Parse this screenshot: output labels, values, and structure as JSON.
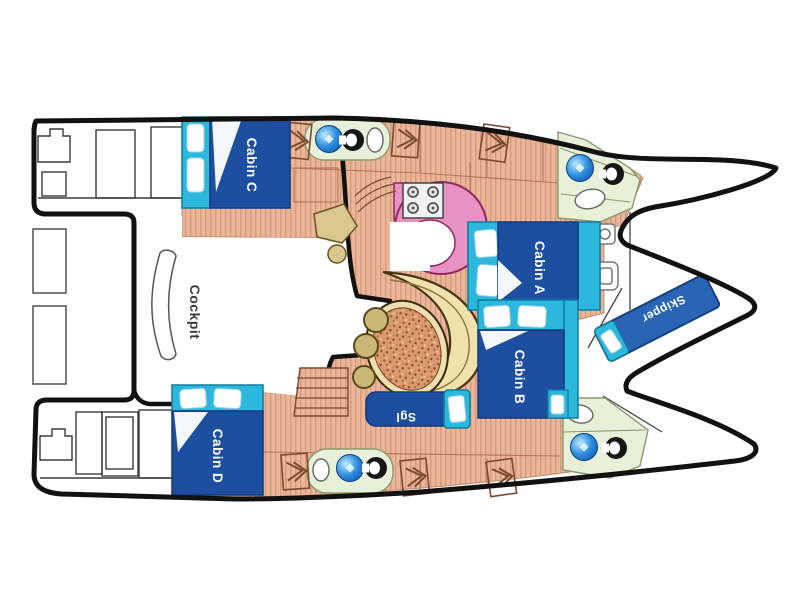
{
  "diagram": {
    "type": "catamaran-deck-plan",
    "labels": {
      "cockpit": "Cockpit",
      "cabin_a": "Cabin A",
      "cabin_b": "Cabin B",
      "cabin_c": "Cabin C",
      "cabin_d": "Cabin D",
      "skipper": "Skipper",
      "single_berth": "Sgl"
    },
    "colors": {
      "hull_outline": "#111111",
      "floor_salmon": "#eab79b",
      "floor_stripe": "#d6997a",
      "bed_blue": "#1d4e9f",
      "bed_blue_dark": "#123a7d",
      "cyan": "#2cb7dc",
      "cyan_dark": "#0d7d9e",
      "skipper_blue": "#2a64b5",
      "galley_pink": "#e891c5",
      "galley_outline": "#93275f",
      "bath_green": "#e7f0d8",
      "bath_outline": "#8a9a6a",
      "bench_cream": "#f0e2ad",
      "bench_outline": "#4a3415",
      "stool_olive": "#c9b878",
      "table_fill": "#d99c72",
      "table_rim": "#ece0b0",
      "thin_line": "#555555",
      "label_white": "#ffffff",
      "cockpit_text": "#3a3a3a"
    },
    "icons": {
      "sink": "blue-sphere",
      "toilet": "black-seat-top-view",
      "hatch": "double-chevron",
      "stove": "four-burner-square"
    }
  }
}
